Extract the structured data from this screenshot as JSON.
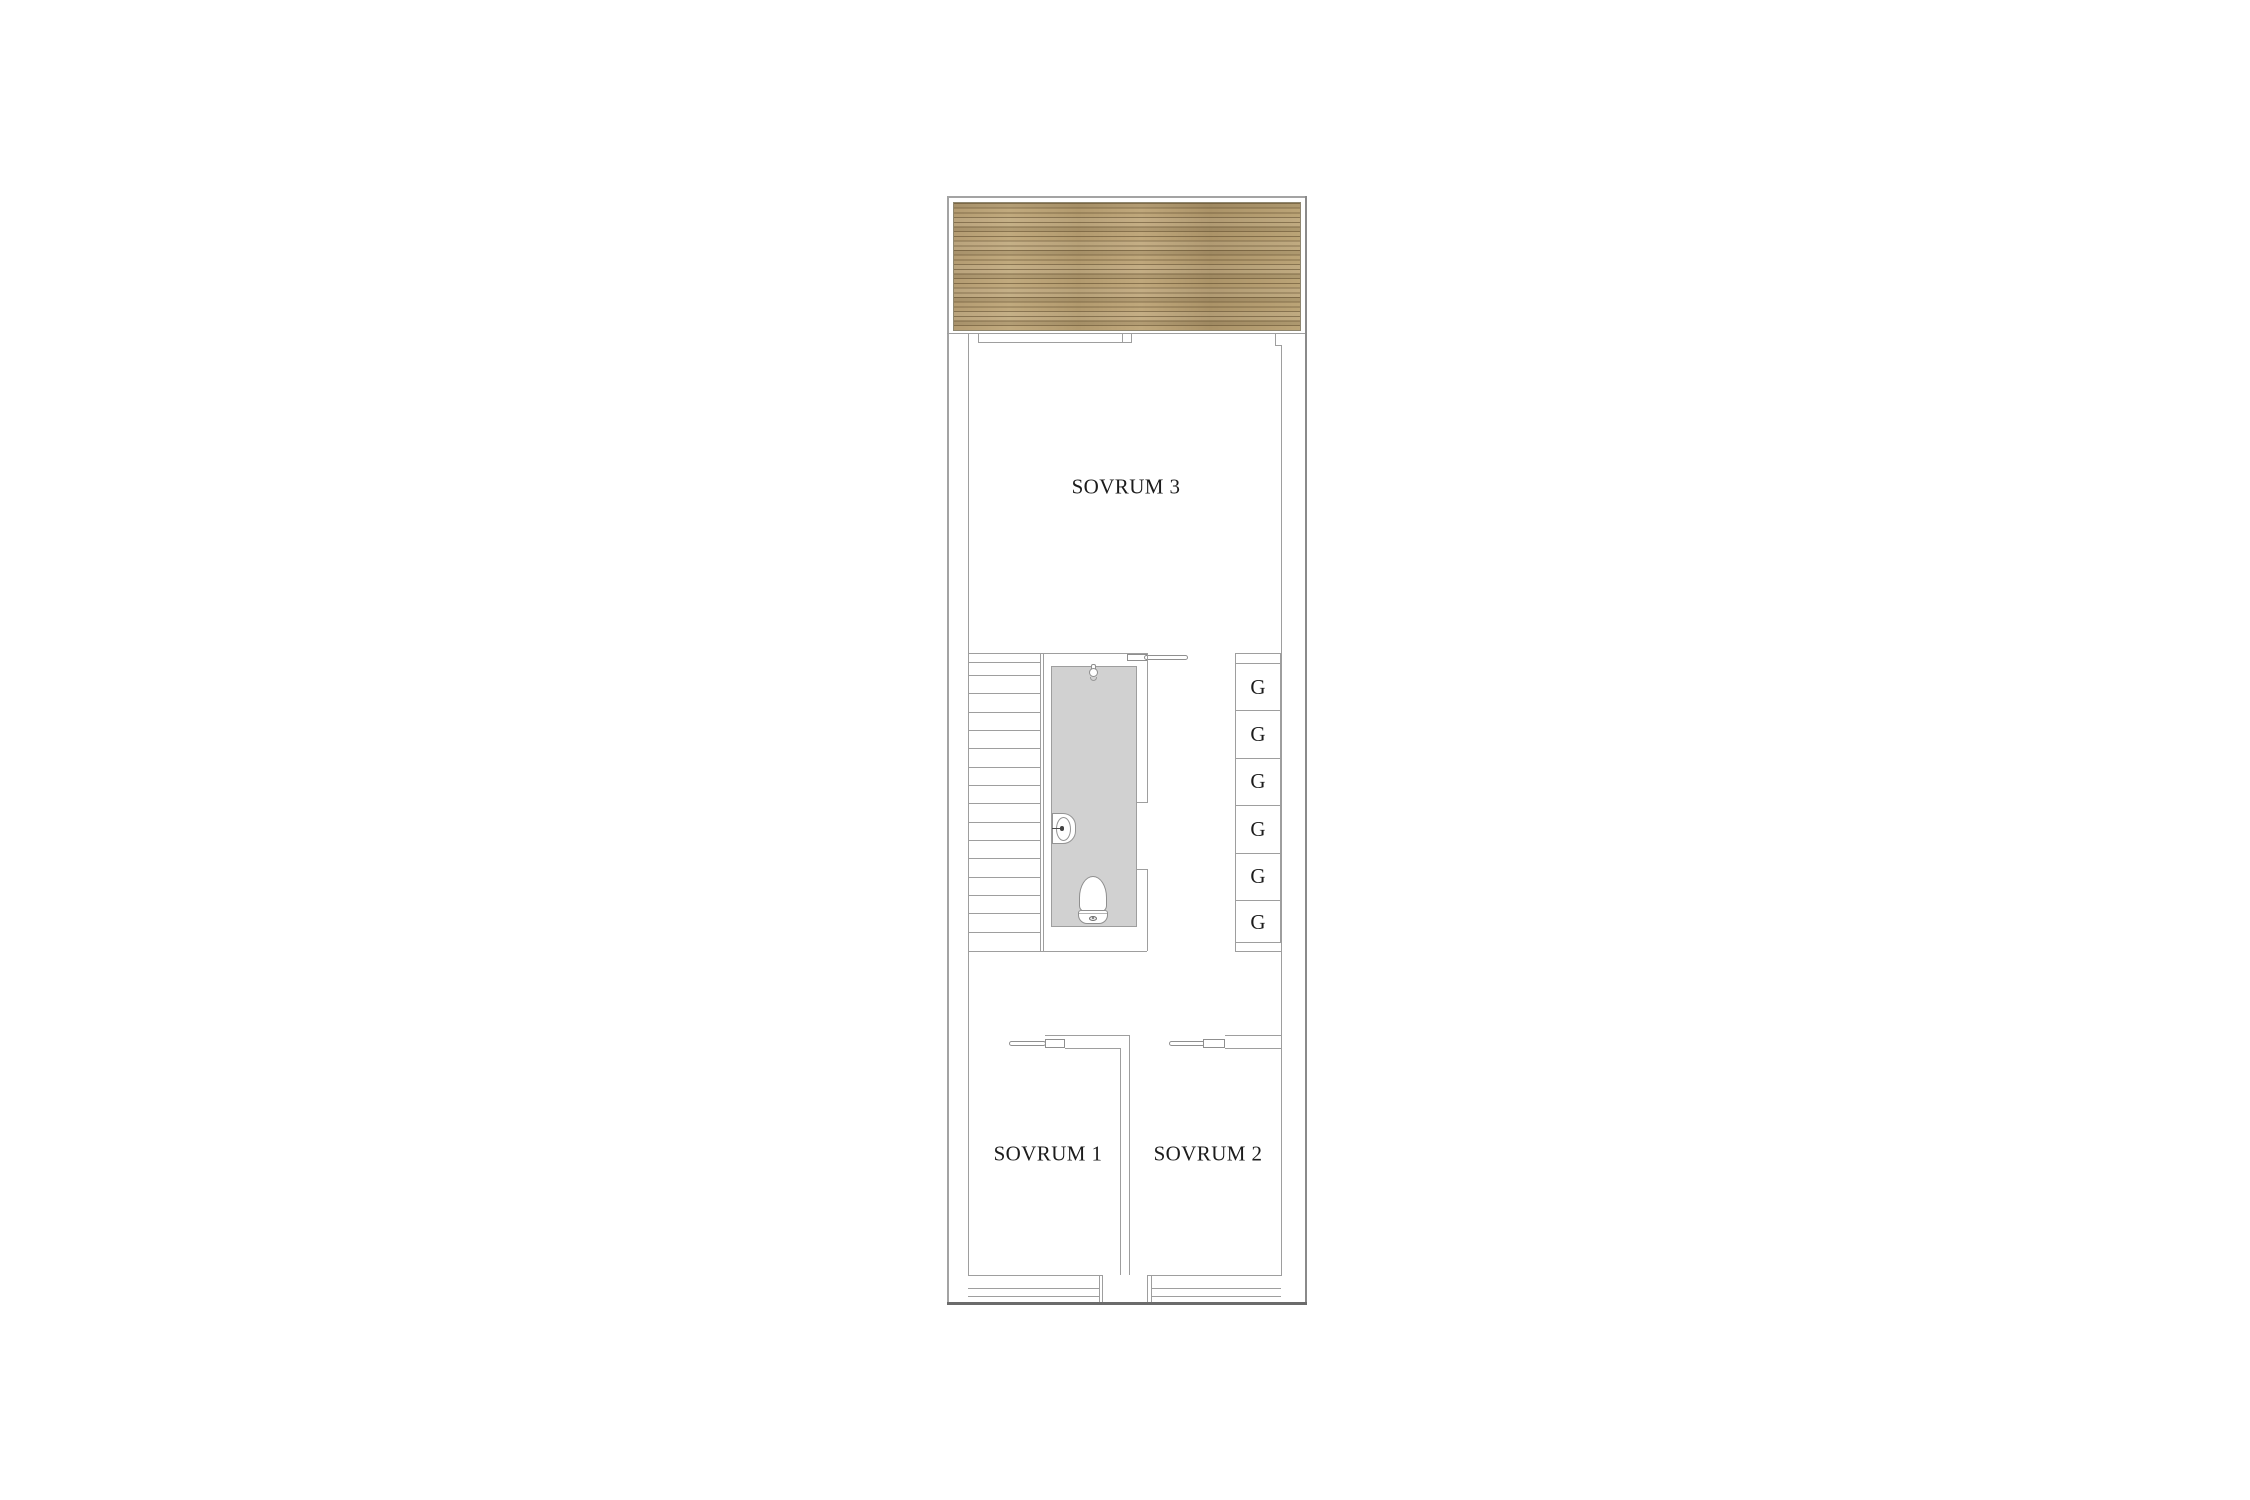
{
  "plan": {
    "type": "floor-plan",
    "rooms": [
      {
        "id": "sovrum3",
        "label": "SOVRUM 3"
      },
      {
        "id": "sovrum1",
        "label": "SOVRUM 1"
      },
      {
        "id": "sovrum2",
        "label": "SOVRUM 2"
      }
    ],
    "closets": {
      "cells": [
        "G",
        "G",
        "G",
        "G",
        "G",
        "G"
      ]
    },
    "staircase": {
      "treads": 16
    },
    "bathroom": {
      "fixtures": [
        "toilet",
        "sink",
        "shower-mixer"
      ]
    },
    "deck": {
      "material": "wood"
    },
    "doors": {
      "sliding_doors": 3
    },
    "windows": 2,
    "colors": {
      "wall_line": "#9e9e9e",
      "outer_wall_dark": "#6b6b6b",
      "bathroom_floor": "#d1d1d1",
      "deck_wood_base": "#b7a076",
      "deck_wood_line": "#8d7852",
      "label_text": "#1c1c1c"
    }
  }
}
